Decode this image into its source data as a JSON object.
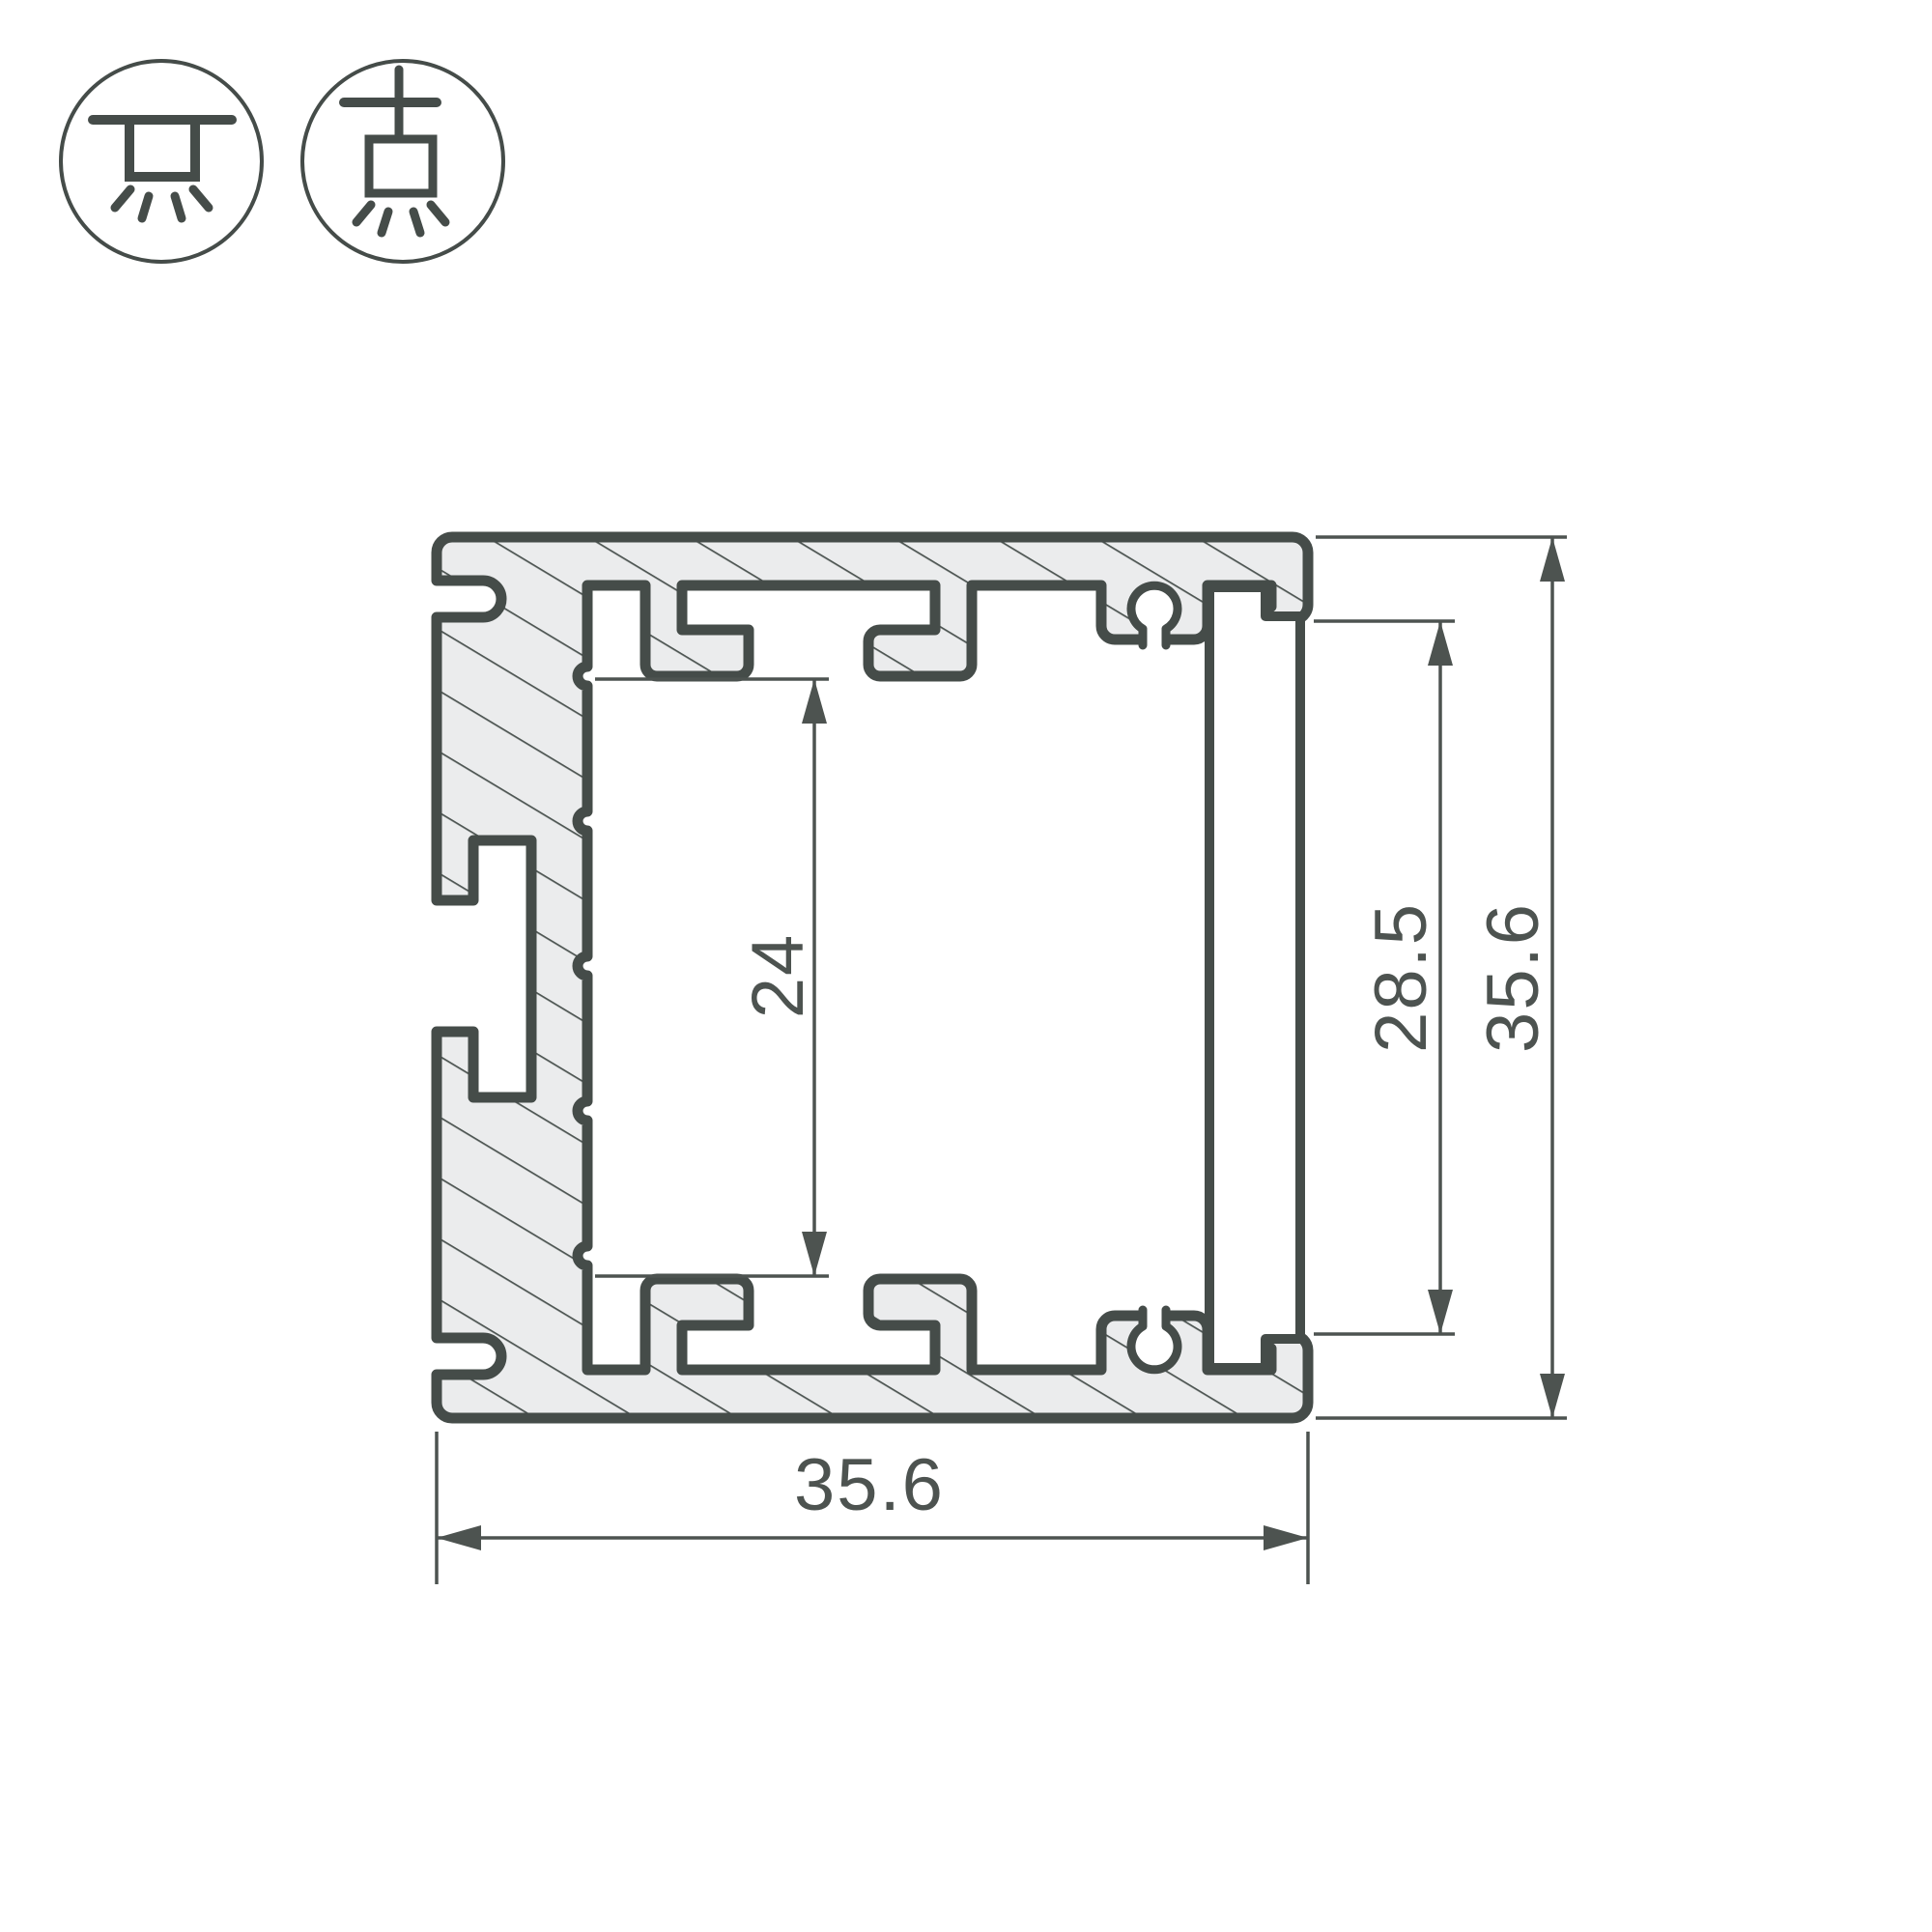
{
  "drawing": {
    "type": "technical cross-section",
    "subject": "aluminium LED profile cross-section with dimensions",
    "units": "mm"
  },
  "colors": {
    "outline": "#454c49",
    "hatch_fill": "#ebeced",
    "hatch_line": "#4d5552",
    "dimension": "#4d5350",
    "background": "#ffffff"
  },
  "icons": {
    "left": {
      "name": "surface-mount-luminaire-icon",
      "meaning": "surface ceiling mounting, light downward"
    },
    "right": {
      "name": "pendant-mount-luminaire-icon",
      "meaning": "suspended ceiling mounting, light downward"
    }
  },
  "dimensions": {
    "cavity_height": "24",
    "opening_height": "28.5",
    "overall_height": "35.6",
    "overall_width": "35.6"
  }
}
